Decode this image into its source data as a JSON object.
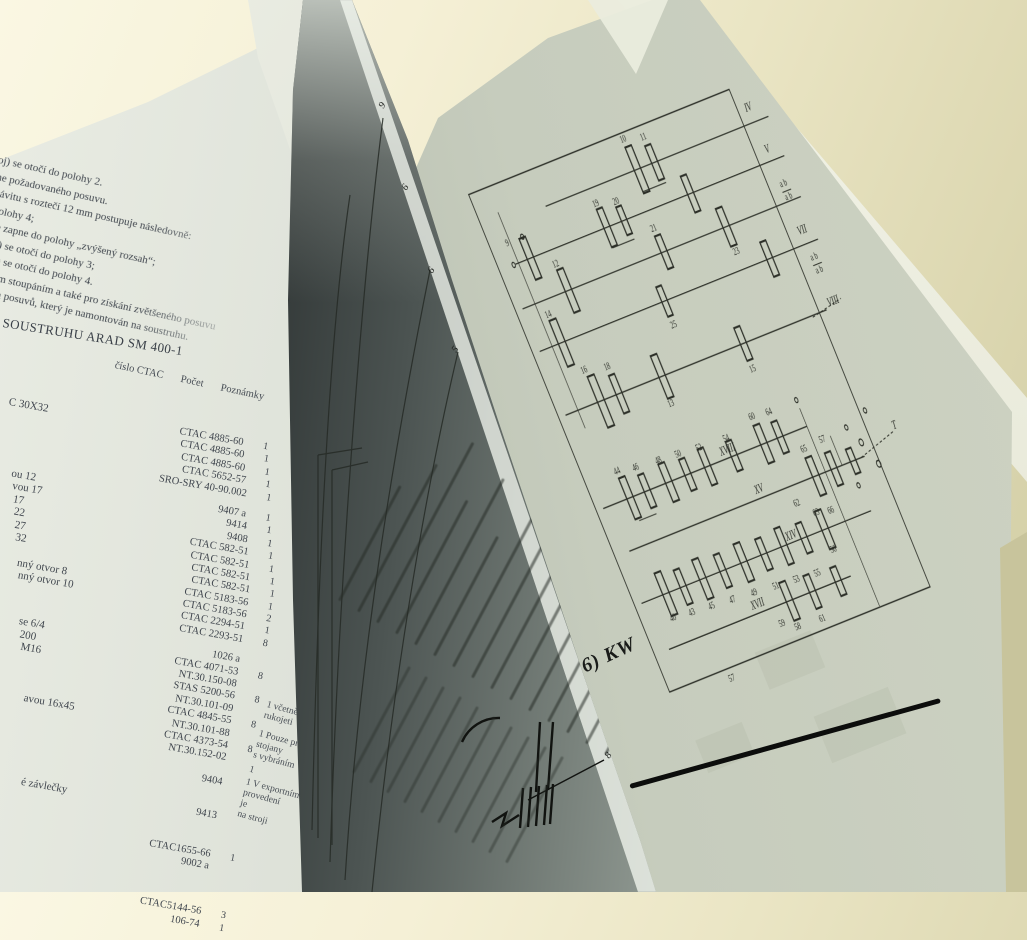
{
  "left_page": {
    "paragraph_lines": [
      "oj) se otočí do polohy 2.",
      "ne požadovaného posuvu.",
      "závitu s roztečí 12 mm postupuje následovně:",
      "polohy 4;",
      "se zapne do polohy „zvýšený rozsah“;",
      "oj) se otočí do polohy 3;",
      "oj) se otočí do polohy 4.",
      "ným stoupáním a také pro získání zvětšeného posuvu",
      "tů a posuvů, který je namontován na soustruhu."
    ],
    "heading": "SOUSTRUHU ARAD SM 400-1",
    "table": {
      "headers": {
        "cislo": "číslo CTAC",
        "pocet": "Počet",
        "poznamky": "Poznámky"
      },
      "rows": [
        {
          "frag": "C 30X32",
          "num": "CTAC 4885-60",
          "qty": "1"
        },
        {
          "num": "CTAC 4885-60",
          "qty": "1"
        },
        {
          "num": "CTAC 4885-60",
          "qty": "1"
        },
        {
          "num": "CTAC 5652-57",
          "qty": "1"
        },
        {
          "num": "SRO-SRY 40-90.002",
          "qty": "1"
        },
        {
          "frag": "ou 12",
          "num": "9407 a",
          "qty": "1",
          "gap": 8
        },
        {
          "frag": "vou 17",
          "num": "9414",
          "qty": "1"
        },
        {
          "frag": "17",
          "num": "9408",
          "qty": "1"
        },
        {
          "frag": "22",
          "num": "CTAC 582-51",
          "qty": "1"
        },
        {
          "frag": "27",
          "num": "CTAC 582-51",
          "qty": "1"
        },
        {
          "frag": "32",
          "num": "CTAC 582-51",
          "qty": "1"
        },
        {
          "num": "CTAC 582-51",
          "qty": "1"
        },
        {
          "frag": "nný otvor 8",
          "num": "CTAC 5183-56",
          "qty": "1"
        },
        {
          "frag": "nný otvor 10",
          "num": "CTAC 5183-56",
          "qty": "2"
        },
        {
          "num": "CTAC 2294-51",
          "qty": "1"
        },
        {
          "num": "CTAC 2293-51",
          "qty": "8"
        },
        {
          "frag": "se 6/4",
          "num": "1026 a",
          "qty": "",
          "gap": 8
        },
        {
          "frag": "200",
          "num": "CTAC 4071-53",
          "qty": "8"
        },
        {
          "frag": "M16",
          "num": "NT.30.150-08",
          "qty": ""
        },
        {
          "num": "STAS 5200-56",
          "qty": "8"
        },
        {
          "num": "NT.30.101-09",
          "qty": ""
        },
        {
          "num": "CTAC 4845-55",
          "qty": "8"
        },
        {
          "frag": "avou 16x45",
          "num": "NT.30.101-88",
          "qty": ""
        },
        {
          "num": "CTAC 4373-54",
          "qty": "8"
        },
        {
          "num": "NT.30.152-02",
          "qty": ""
        },
        {
          "num": "9404",
          "qty": "",
          "gap": 12
        },
        {
          "frag": "é závlečky",
          "num": "9413",
          "qty": "",
          "gap": 22
        },
        {
          "num": "CTAC1655-66",
          "qty": "1",
          "gap": 26
        },
        {
          "num": "9002 a",
          "qty": ""
        },
        {
          "num": "CTAC5144-56",
          "qty": "3",
          "gap": 34
        },
        {
          "num": "106-74",
          "qty": "1"
        }
      ],
      "notes": [
        "1 včetně\nrukojeti",
        "1 Pouze pro\nstojany\ns vybráním",
        "1",
        "1 V exportním\nprovedení\nje\nna stroji"
      ]
    }
  },
  "turning_page": {
    "leader_labels": [
      {
        "t": "9",
        "x": 380,
        "y": 100
      },
      {
        "t": "6",
        "x": 403,
        "y": 182
      },
      {
        "t": "6",
        "x": 429,
        "y": 265
      },
      {
        "t": "5",
        "x": 453,
        "y": 344
      },
      {
        "t": "8",
        "x": 606,
        "y": 750
      }
    ]
  },
  "right_page": {
    "handwritten_note": "6) KW",
    "diagram": {
      "shafts": [
        {
          "x1": 160,
          "x2": 626,
          "y": 70
        },
        {
          "x1": 64,
          "x2": 626,
          "y": 118
        },
        {
          "x1": 44,
          "x2": 626,
          "y": 168
        },
        {
          "x1": 44,
          "x2": 626,
          "y": 220
        },
        {
          "x1": 44,
          "x2": 590,
          "y": 298
        },
        {
          "x1": 44,
          "x2": 470,
          "y": 412
        },
        {
          "x1": 60,
          "x2": 552,
          "y": 468
        },
        {
          "x1": 44,
          "x2": 524,
          "y": 528
        },
        {
          "x1": 60,
          "x2": 440,
          "y": 588
        }
      ],
      "gears": [
        {
          "x": 352,
          "y": 70,
          "w": 13,
          "h": 56
        },
        {
          "x": 388,
          "y": 70,
          "w": 12,
          "h": 42
        },
        {
          "x": 95,
          "y": 118,
          "w": 13,
          "h": 50
        },
        {
          "x": 255,
          "y": 118,
          "w": 12,
          "h": 46
        },
        {
          "x": 291,
          "y": 118,
          "w": 11,
          "h": 34
        },
        {
          "x": 430,
          "y": 118,
          "w": 12,
          "h": 44
        },
        {
          "x": 140,
          "y": 168,
          "w": 13,
          "h": 52
        },
        {
          "x": 340,
          "y": 168,
          "w": 12,
          "h": 40
        },
        {
          "x": 470,
          "y": 168,
          "w": 13,
          "h": 46
        },
        {
          "x": 90,
          "y": 220,
          "w": 14,
          "h": 56
        },
        {
          "x": 305,
          "y": 220,
          "w": 11,
          "h": 36
        },
        {
          "x": 525,
          "y": 220,
          "w": 12,
          "h": 42
        },
        {
          "x": 118,
          "y": 298,
          "w": 14,
          "h": 62
        },
        {
          "x": 156,
          "y": 298,
          "w": 12,
          "h": 46
        },
        {
          "x": 246,
          "y": 298,
          "w": 13,
          "h": 52
        },
        {
          "x": 416,
          "y": 298,
          "w": 12,
          "h": 40
        },
        {
          "x": 100,
          "y": 412,
          "w": 13,
          "h": 50
        },
        {
          "x": 136,
          "y": 412,
          "w": 12,
          "h": 40
        },
        {
          "x": 181,
          "y": 412,
          "w": 13,
          "h": 46
        },
        {
          "x": 221,
          "y": 412,
          "w": 12,
          "h": 38
        },
        {
          "x": 262,
          "y": 412,
          "w": 12,
          "h": 44
        },
        {
          "x": 318,
          "y": 412,
          "w": 12,
          "h": 36
        },
        {
          "x": 380,
          "y": 412,
          "w": 13,
          "h": 46
        },
        {
          "x": 414,
          "y": 412,
          "w": 12,
          "h": 38
        },
        {
          "x": 450,
          "y": 468,
          "w": 13,
          "h": 46
        },
        {
          "x": 488,
          "y": 468,
          "w": 12,
          "h": 40
        },
        {
          "x": 528,
          "y": 468,
          "w": 11,
          "h": 30
        },
        {
          "x": 95,
          "y": 528,
          "w": 13,
          "h": 52
        },
        {
          "x": 131,
          "y": 528,
          "w": 12,
          "h": 42
        },
        {
          "x": 172,
          "y": 528,
          "w": 13,
          "h": 48
        },
        {
          "x": 214,
          "y": 528,
          "w": 12,
          "h": 40
        },
        {
          "x": 258,
          "y": 528,
          "w": 13,
          "h": 46
        },
        {
          "x": 300,
          "y": 528,
          "w": 12,
          "h": 38
        },
        {
          "x": 342,
          "y": 528,
          "w": 12,
          "h": 44
        },
        {
          "x": 384,
          "y": 528,
          "w": 12,
          "h": 36
        },
        {
          "x": 428,
          "y": 528,
          "w": 13,
          "h": 46
        },
        {
          "x": 312,
          "y": 588,
          "w": 13,
          "h": 46
        },
        {
          "x": 360,
          "y": 588,
          "w": 12,
          "h": 40
        },
        {
          "x": 414,
          "y": 588,
          "w": 12,
          "h": 34
        }
      ],
      "links": [
        {
          "x1": 70,
          "y1": 56,
          "x2": 70,
          "y2": 320
        },
        {
          "x1": 470,
          "y1": 390,
          "x2": 470,
          "y2": 632
        },
        {
          "x1": 346,
          "y1": 96,
          "x2": 394,
          "y2": 96
        },
        {
          "x1": 250,
          "y1": 142,
          "x2": 296,
          "y2": 142
        },
        {
          "x1": 100,
          "y1": 440,
          "x2": 136,
          "y2": 440
        },
        {
          "x1": 596,
          "y1": 156,
          "x2": 614,
          "y2": 156
        },
        {
          "x1": 598,
          "y1": 246,
          "x2": 616,
          "y2": 246
        },
        {
          "x1": 505,
          "y1": 432,
          "x2": 505,
          "y2": 468
        },
        {
          "x1": 545,
          "y1": 468,
          "x2": 622,
          "y2": 454,
          "d": 1
        },
        {
          "x1": 560,
          "y1": 300,
          "x2": 624,
          "y2": 292,
          "d": 1
        }
      ],
      "circles": [
        {
          "x": 556,
          "y": 452,
          "r": 4
        },
        {
          "x": 572,
          "y": 482,
          "r": 4
        },
        {
          "x": 540,
          "y": 430,
          "r": 3
        },
        {
          "x": 586,
          "y": 420,
          "r": 3
        },
        {
          "x": 96,
          "y": 92,
          "r": 3
        },
        {
          "x": 60,
          "y": 118,
          "r": 3
        },
        {
          "x": 520,
          "y": 496,
          "r": 3
        },
        {
          "x": 470,
          "y": 380,
          "r": 3
        }
      ],
      "labels": [
        {
          "t": "IV",
          "x": 596,
          "y": 56,
          "big": 1
        },
        {
          "t": "V",
          "x": 600,
          "y": 108,
          "big": 1
        },
        {
          "t": "VII",
          "x": 604,
          "y": 208,
          "big": 1
        },
        {
          "t": "VIII",
          "x": 608,
          "y": 296,
          "big": 1
        },
        {
          "t": "XVIII",
          "x": 310,
          "y": 407,
          "big": 1
        },
        {
          "t": "XV",
          "x": 338,
          "y": 462,
          "big": 1
        },
        {
          "t": "XIV",
          "x": 362,
          "y": 524,
          "big": 1
        },
        {
          "t": "XVII",
          "x": 252,
          "y": 582,
          "big": 1
        },
        {
          "t": "T",
          "x": 628,
          "y": 452,
          "big": 1
        },
        {
          "t": "a b",
          "x": 604,
          "y": 150
        },
        {
          "t": "a b",
          "x": 604,
          "y": 166
        },
        {
          "t": "a b",
          "x": 606,
          "y": 240
        },
        {
          "t": "a b",
          "x": 606,
          "y": 256
        },
        {
          "t": "10",
          "x": 348,
          "y": 36
        },
        {
          "t": "11",
          "x": 386,
          "y": 42
        },
        {
          "t": "19",
          "x": 252,
          "y": 92
        },
        {
          "t": "20",
          "x": 290,
          "y": 98
        },
        {
          "t": "9",
          "x": 64,
          "y": 96
        },
        {
          "t": "12",
          "x": 136,
          "y": 138
        },
        {
          "t": "21",
          "x": 338,
          "y": 142
        },
        {
          "t": "23",
          "x": 470,
          "y": 202
        },
        {
          "t": "14",
          "x": 86,
          "y": 188
        },
        {
          "t": "25",
          "x": 304,
          "y": 252
        },
        {
          "t": "16",
          "x": 110,
          "y": 262
        },
        {
          "t": "18",
          "x": 154,
          "y": 268
        },
        {
          "t": "13",
          "x": 242,
          "y": 334
        },
        {
          "t": "15",
          "x": 414,
          "y": 332
        },
        {
          "t": "44",
          "x": 96,
          "y": 382
        },
        {
          "t": "46",
          "x": 132,
          "y": 386
        },
        {
          "t": "48",
          "x": 178,
          "y": 388
        },
        {
          "t": "50",
          "x": 218,
          "y": 390
        },
        {
          "t": "52",
          "x": 260,
          "y": 392
        },
        {
          "t": "54",
          "x": 316,
          "y": 394
        },
        {
          "t": "60",
          "x": 378,
          "y": 382
        },
        {
          "t": "64",
          "x": 412,
          "y": 384
        },
        {
          "t": "57",
          "x": 488,
          "y": 436
        },
        {
          "t": "65",
          "x": 448,
          "y": 438
        },
        {
          "t": "62",
          "x": 396,
          "y": 492
        },
        {
          "t": "63",
          "x": 424,
          "y": 510
        },
        {
          "t": "66",
          "x": 452,
          "y": 514
        },
        {
          "t": "40",
          "x": 90,
          "y": 560
        },
        {
          "t": "43",
          "x": 128,
          "y": 562
        },
        {
          "t": "45",
          "x": 168,
          "y": 564
        },
        {
          "t": "47",
          "x": 210,
          "y": 566
        },
        {
          "t": "49",
          "x": 254,
          "y": 568
        },
        {
          "t": "51",
          "x": 298,
          "y": 570
        },
        {
          "t": "53",
          "x": 340,
          "y": 572
        },
        {
          "t": "55",
          "x": 382,
          "y": 574
        },
        {
          "t": "56",
          "x": 428,
          "y": 556
        },
        {
          "t": "58",
          "x": 308,
          "y": 622
        },
        {
          "t": "61",
          "x": 358,
          "y": 624
        },
        {
          "t": "59",
          "x": 282,
          "y": 612
        },
        {
          "t": "57",
          "x": 152,
          "y": 648
        }
      ]
    }
  }
}
